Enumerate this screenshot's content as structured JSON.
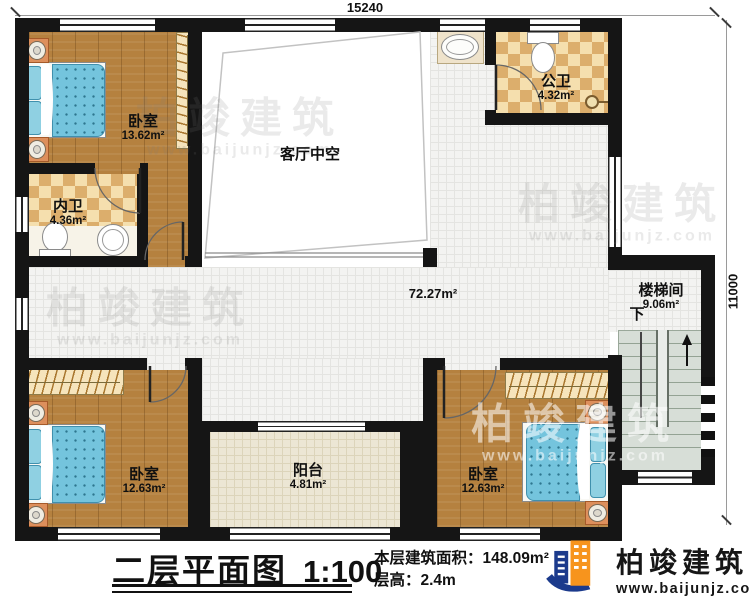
{
  "plan": {
    "dimensions": {
      "width_mm": "15240",
      "height_mm": "11000"
    },
    "rooms": {
      "bedroom_tl": {
        "name": "卧室",
        "area": "13.62m²"
      },
      "inner_bath": {
        "name": "内卫",
        "area": "4.36m²"
      },
      "living_void": {
        "name": "客厅中空"
      },
      "public_bath": {
        "name": "公卫",
        "area": "4.32m²"
      },
      "hall": {
        "area": "72.27m²"
      },
      "stairwell": {
        "name": "楼梯间",
        "area": "9.06m²",
        "down_label": "下"
      },
      "bedroom_bl": {
        "name": "卧室",
        "area": "12.63m²"
      },
      "balcony": {
        "name": "阳台",
        "area": "4.81m²"
      },
      "bedroom_br": {
        "name": "卧室",
        "area": "12.63m²"
      }
    }
  },
  "title_block": {
    "title": "二层平面图",
    "scale": "1:100",
    "area_line": "本层建筑面积：148.09m²",
    "height_line": "层高：2.4m"
  },
  "branding": {
    "company": "柏竣建筑",
    "website": "www.baijunjz.com"
  },
  "colors": {
    "wall": "#151515",
    "wood_floor": "#b5813f",
    "bath_tile": "#dcae6c",
    "corridor_tile": "#f3f3f1",
    "balcony_tile": "#ece6d4",
    "stairs": "#d7ded7",
    "mattress_blue": "#74c4dd",
    "brand_blue": "#1b3a8c",
    "brand_orange": "#f7941d"
  }
}
